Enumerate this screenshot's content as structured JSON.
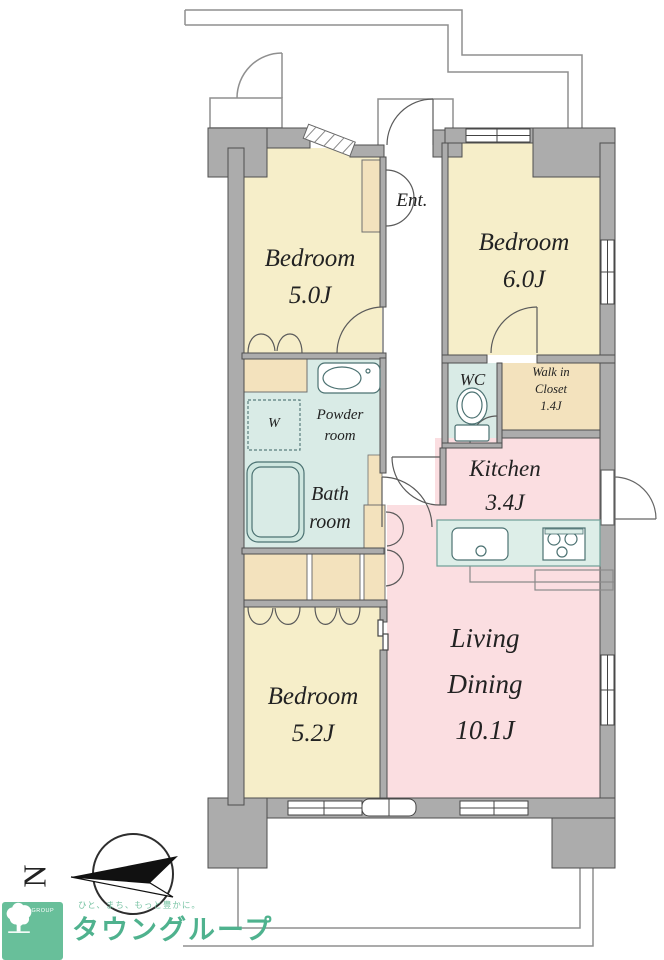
{
  "floorplan": {
    "rooms": {
      "bedroom1": {
        "name": "Bedroom",
        "size": "5.0J"
      },
      "bedroom2": {
        "name": "Bedroom",
        "size": "6.0J"
      },
      "bedroom3": {
        "name": "Bedroom",
        "size": "5.2J"
      },
      "living_dining": {
        "line1": "Living",
        "line2": "Dining",
        "size": "10.1J"
      },
      "kitchen": {
        "name": "Kitchen",
        "size": "3.4J"
      },
      "entrance": {
        "label": "Ent."
      },
      "wc": {
        "label": "WC"
      },
      "walk_in_closet": {
        "line1": "Walk in",
        "line2": "Closet",
        "size": "1.4J"
      },
      "powder_room": {
        "line1": "Powder",
        "line2": "room"
      },
      "bathroom": {
        "line1": "Bath",
        "line2": "room"
      },
      "washer": {
        "label": "W"
      }
    },
    "compass": {
      "north_label": "N"
    }
  },
  "branding": {
    "logo_text": "TOWN GROUP",
    "brand_name": "タウングループ",
    "tagline": "ひと、まち、もっと豊かに。",
    "brand_color": "#4fb28e",
    "logo_bg": "#68bf9a"
  },
  "palette": {
    "wall_fill": "#acacac",
    "wall_line": "#4e4e4e",
    "outline_thin": "#8f8f8f",
    "room_cream": "#f6eec9",
    "closet_beige": "#f3e2bd",
    "wet_teal": "#d9ebe6",
    "pink": "#fbdee1",
    "counter_teal": "#ddeee8",
    "fixture_line": "#4c7272"
  }
}
